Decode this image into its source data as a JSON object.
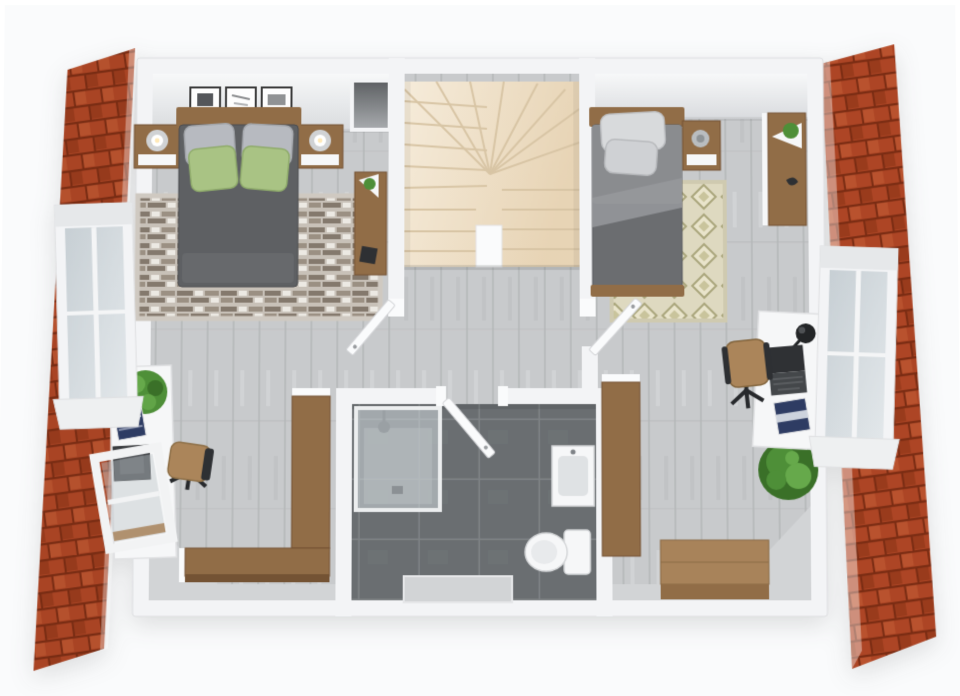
{
  "scene": {
    "kind": "3d-floorplan-render",
    "view": "top-down cutaway of an attic floor",
    "width": 960,
    "height": 696
  },
  "palette": {
    "page_bg": "#ffffff",
    "roof_brick": "#b54a28",
    "roof_brick_dark": "#7e2f15",
    "roof_brick_light": "#c25832",
    "roof_brick_deep": "#a03f1f",
    "wall_white": "#f3f4f6",
    "wall_bright": "#fafbfc",
    "ceiling_shade": "#dcdee1",
    "floor_wood": "#c8cacc",
    "floor_seam": "#b4b6b8",
    "floor_streak": "#d5d7d9",
    "bath_tile": "#6a6e71",
    "bath_grout": "#7f8386",
    "stairs_tread": "#f1e4cf",
    "stairs_line": "#d8c5a5",
    "rug1_base": "#c8c1b8",
    "rug1_stripe": "#84796d",
    "rug1_stripe2": "#9b9083",
    "rug1_dash": "#ece9e3",
    "rug2_base": "#ded9c0",
    "rug2_diamond": "#aaa67c",
    "wood_furniture": "#916d47",
    "wood_dark": "#745334",
    "wood_light": "#a8835a",
    "bed1_duvet": "#5e6063",
    "bed2_duvet": "#6b6d70",
    "bed2_sheet": "#8a8c8f",
    "pillow_gray": "#b7bac0",
    "pillow_green": "#a9c384",
    "white_fixture": "#f6f7f8",
    "glass": "#ccd4d9",
    "plant_green": "#4e8f38",
    "plant_dark": "#3a7028",
    "plant_light": "#66a94b",
    "chair_tan": "#ab855a",
    "metal_dark": "#2e3033",
    "knee_wall": "#d2d4d6",
    "book_blue": "#2e3c63",
    "niche_dark": "#5f6265"
  },
  "building": {
    "roof": "red clay brick tile slopes on east and west sides",
    "dormers": [
      "west dormer window with white frame",
      "east dormer window with white frame"
    ],
    "walls": "white cutaway walls",
    "floor": "light gray wood planks"
  },
  "rooms": [
    {
      "id": "bedroom-1",
      "label": "master bedroom (top left)",
      "items": [
        "double bed with dark gray duvet",
        "two gray pillows",
        "two green pillows",
        "wood headboard",
        "left nightstand with lamp",
        "right nightstand with lamp",
        "striped taupe area rug",
        "three framed pictures on wall",
        "tall wood console with plant",
        "dark wall niche"
      ]
    },
    {
      "id": "staircase",
      "label": "U-shaped winder staircase (top center)",
      "items": [
        "beige fanned treads",
        "white center landing post"
      ]
    },
    {
      "id": "bedroom-2",
      "label": "second bedroom (top right)",
      "items": [
        "single bed with gray duvet",
        "two light pillows",
        "wood headboard",
        "wood footboard",
        "nightstand with candle",
        "diamond-pattern rug",
        "wood wardrobe cabinet with plant"
      ]
    },
    {
      "id": "hallway",
      "label": "open landing / hallway (center)",
      "items": [
        "open door to bedroom 1",
        "open door to bedroom 2",
        "open door to bathroom"
      ]
    },
    {
      "id": "bathroom",
      "label": "bathroom (bottom center)",
      "items": [
        "dark gray tile floor",
        "glass shower enclosure with shower head",
        "white washbasin vanity",
        "toilet",
        "gray dormer recess"
      ]
    },
    {
      "id": "study-left",
      "label": "study nook (bottom left)",
      "items": [
        "white desk",
        "potted plant",
        "stack of blue books",
        "monitor",
        "open roof window over desk",
        "office chair with tan seat",
        "L-shaped wood bench"
      ]
    },
    {
      "id": "study-right",
      "label": "study nook (bottom right)",
      "items": [
        "white desk",
        "laptop",
        "black desk lamp",
        "magazine",
        "office chair with tan seat",
        "large floor plant",
        "wood bench",
        "wood storage chest"
      ]
    }
  ]
}
